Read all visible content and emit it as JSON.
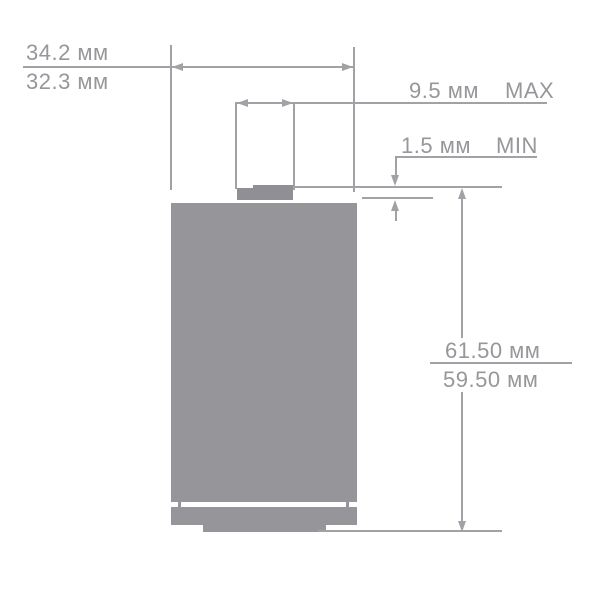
{
  "labels": {
    "width_max": "34.2 мм",
    "width_min": "32.3 мм",
    "button_width": "9.5 мм",
    "button_width_qualifier": "MAX",
    "button_height": "1.5 мм",
    "button_height_qualifier": "MIN",
    "height_max": "61.50 мм",
    "height_min": "59.50 мм"
  },
  "colors": {
    "background": "#ffffff",
    "body": "#95959a",
    "button": "#8f8f95",
    "line": "#a2a2a6",
    "text": "#97979b"
  }
}
